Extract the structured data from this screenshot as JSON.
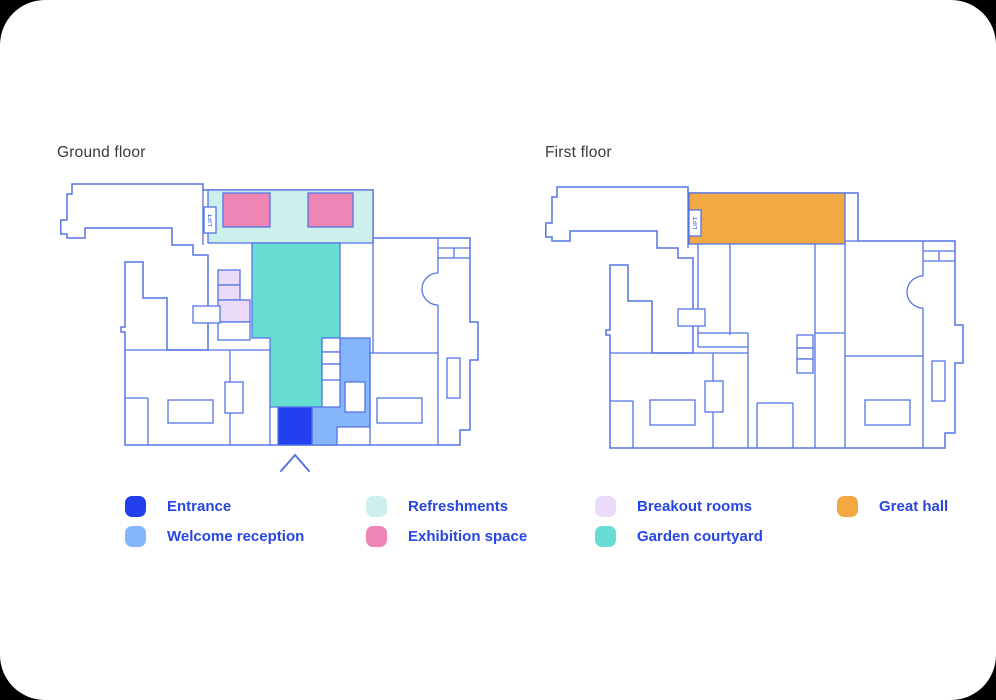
{
  "page": {
    "background_color": "#000000",
    "card_background": "#ffffff"
  },
  "floors": [
    {
      "title": "Ground floor",
      "lift_label": "LIFT"
    },
    {
      "title": "First floor",
      "lift_label": "LIFT"
    }
  ],
  "region_colors": {
    "entrance": "#2340ee",
    "welcome_reception": "#85b5fa",
    "refreshments": "#cdf0ec",
    "exhibition_space": "#ee86b5",
    "breakout_rooms": "#e9dbf9",
    "garden_courtyard": "#67dcd3",
    "great_hall": "#f2a843"
  },
  "legend": {
    "items": [
      {
        "key": "entrance",
        "label": "Entrance"
      },
      {
        "key": "welcome_reception",
        "label": "Welcome reception"
      },
      {
        "key": "refreshments",
        "label": "Refreshments"
      },
      {
        "key": "exhibition_space",
        "label": "Exhibition space"
      },
      {
        "key": "breakout_rooms",
        "label": "Breakout rooms"
      },
      {
        "key": "garden_courtyard",
        "label": "Garden courtyard"
      },
      {
        "key": "great_hall",
        "label": "Great hall"
      }
    ]
  },
  "colors": {
    "wall_stroke": "#5574e7",
    "legend_text": "#2746e3",
    "title_text": "#3a3a3a"
  }
}
